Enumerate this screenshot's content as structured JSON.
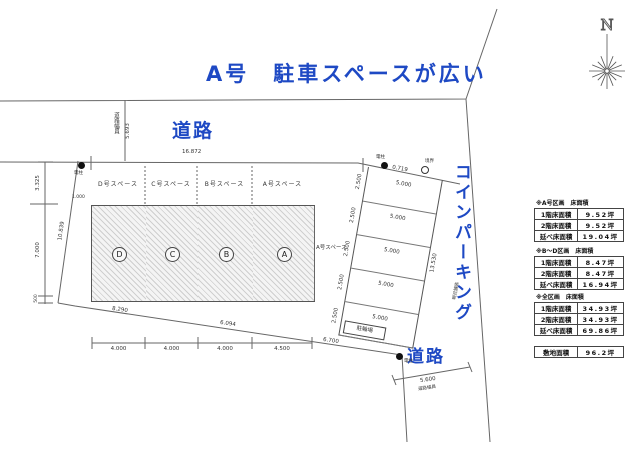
{
  "title": "A号　駐車スペースが広い",
  "colors": {
    "accent_blue": "#1e49c4",
    "line": "#555555"
  },
  "compass": {
    "label": "N"
  },
  "roads": {
    "top": "道路",
    "bottom_right": "道路",
    "coin_parking": "コインパーキング"
  },
  "road_width_top": {
    "label": "道路幅員",
    "value": "5.693"
  },
  "road_width_bottom": {
    "label": "道路幅員",
    "value": "5.600"
  },
  "lots": [
    {
      "letter": "D",
      "space_label": "D号スペース"
    },
    {
      "letter": "C",
      "space_label": "C号スペース"
    },
    {
      "letter": "B",
      "space_label": "B号スペース"
    },
    {
      "letter": "A",
      "space_label": "A号スペース"
    }
  ],
  "extra_space_label": "A号スペース",
  "dims": {
    "top_width": "16.872",
    "left_upper": "3.325",
    "left_mid": "7.000",
    "left_lower": "500",
    "west_slant": "10.839",
    "offset": "1.000",
    "bottom_widths": [
      "4.000",
      "4.000",
      "4.000",
      "4.500"
    ],
    "south": [
      "8.290",
      "6.094",
      "6.700"
    ],
    "strip_top": "0.719",
    "strip_length": "13.530",
    "strip_rows": [
      "2.500",
      "2.500",
      "2.500",
      "2.500",
      "2.500"
    ],
    "strip_cells": [
      "5.000",
      "5.000",
      "5.000",
      "5.000",
      "5.000"
    ]
  },
  "markers": {
    "pole": "電柱",
    "boundary": "境界",
    "shed": "駐輪場",
    "pavement_note": "現況舗装"
  },
  "tables": [
    {
      "header": "※A号区画　床面積",
      "rows": [
        [
          "1階床面積",
          "9.52坪"
        ],
        [
          "2階床面積",
          "9.52坪"
        ],
        [
          "延べ床面積",
          "19.04坪"
        ]
      ]
    },
    {
      "header": "※B～D区画　床面積",
      "rows": [
        [
          "1階床面積",
          "8.47坪"
        ],
        [
          "2階床面積",
          "8.47坪"
        ],
        [
          "延べ床面積",
          "16.94坪"
        ]
      ]
    },
    {
      "header": "※全区画　床面積",
      "rows": [
        [
          "1階床面積",
          "34.93坪"
        ],
        [
          "2階床面積",
          "34.93坪"
        ],
        [
          "延べ床面積",
          "69.86坪"
        ]
      ]
    }
  ],
  "site_area": {
    "label": "敷地面積",
    "value": "96.2坪"
  }
}
